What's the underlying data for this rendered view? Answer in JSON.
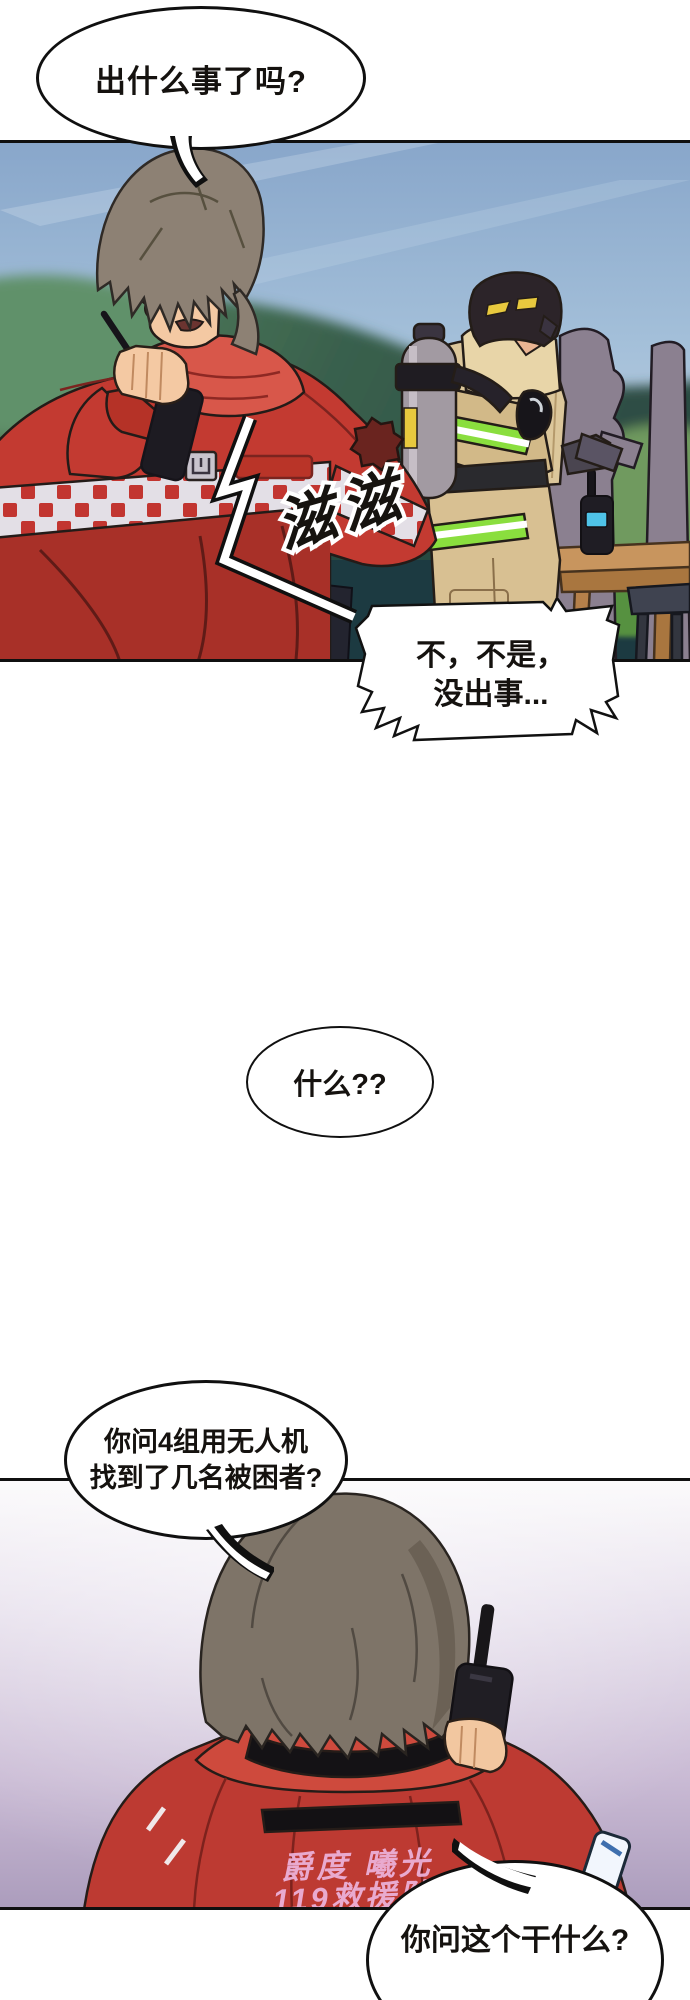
{
  "comic": {
    "bubble1": {
      "text": "出什么事了吗?"
    },
    "bubble2": {
      "line1": "不，不是，",
      "line2": "没出事..."
    },
    "bubble3": {
      "text": "什么??"
    },
    "bubble4": {
      "line1": "你问4组用无人机",
      "line2": "找到了几名被困者?"
    },
    "bubble5": {
      "text": "你问这个干什么?"
    },
    "sfx": {
      "text": "滋滋"
    },
    "jacket_back": {
      "line1": "爵度 曦光",
      "line2": "119救援队"
    }
  },
  "colors": {
    "jacket_red": "#c33a31",
    "jacket_red_dark": "#9c2d27",
    "collar_red": "#d8574a",
    "hivis_green": "#8ade3e",
    "suit_tan": "#dcc79b",
    "sky_blue": "#9db9d8",
    "hill_green": "#39604d",
    "ground_dark": "#1c3a41",
    "panel2_lavender": "#c9bad6",
    "back_text_pink": "#ecb0d8",
    "radio_screen_cyan": "#4fc3e8",
    "outline_black": "#101010"
  }
}
